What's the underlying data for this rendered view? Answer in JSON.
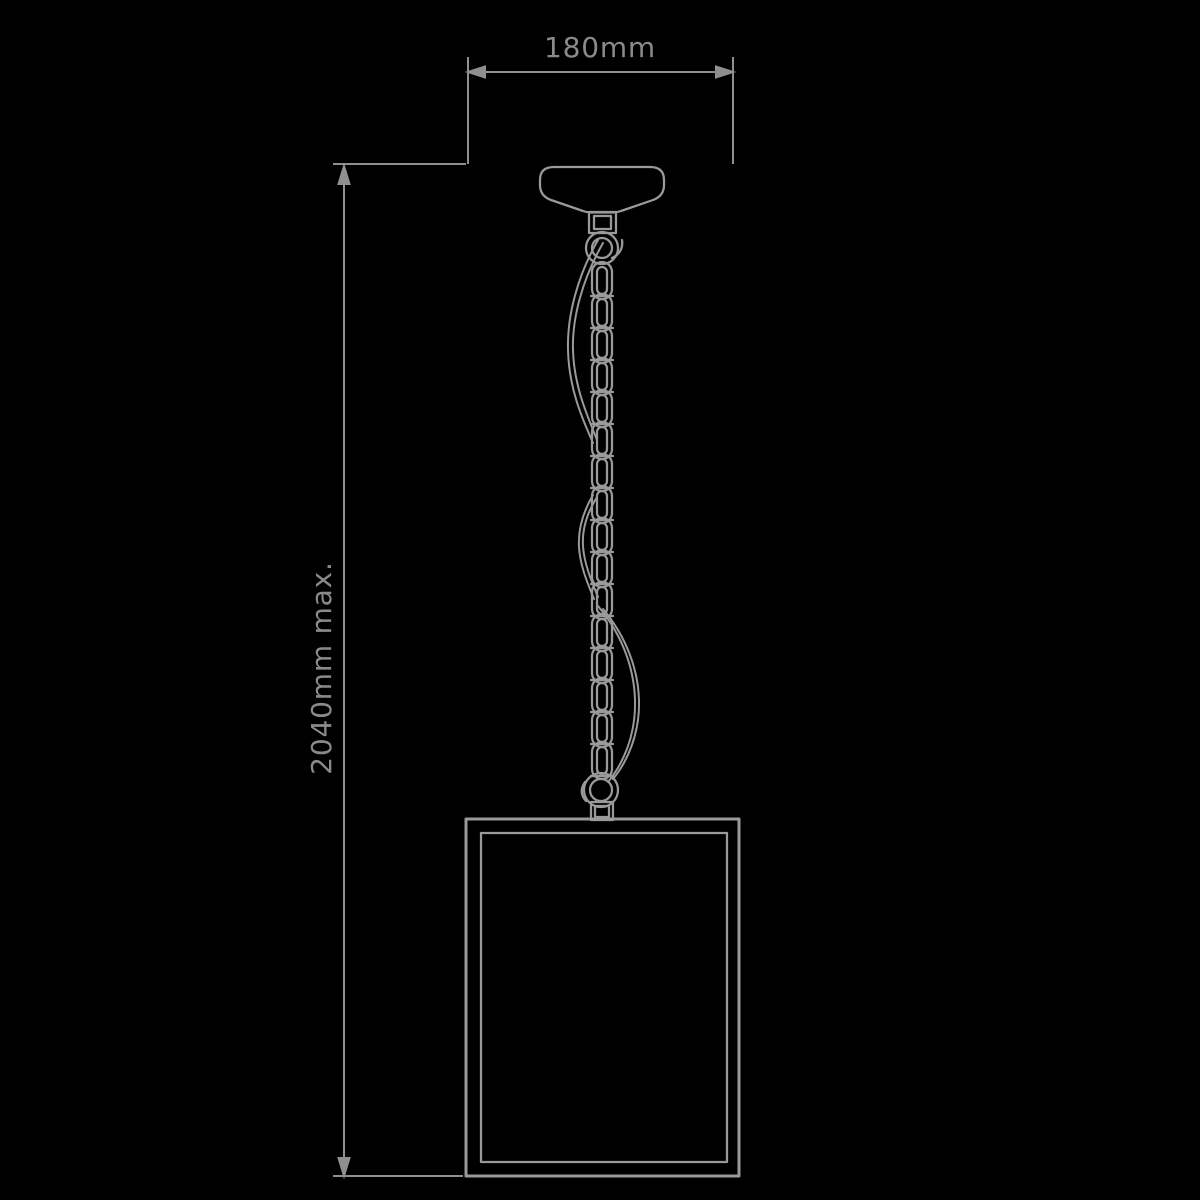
{
  "page": {
    "background": "#000000",
    "title": "Pendant light dimension drawing"
  },
  "drawing": {
    "width_dimension": {
      "label": "180mm"
    },
    "height_dimension": {
      "label": "2040mm max."
    },
    "colors": {
      "dimension_lines": "#8f8f8f",
      "label_text": "#8a8a8a",
      "artwork_lines": "#9a9a9a"
    }
  }
}
